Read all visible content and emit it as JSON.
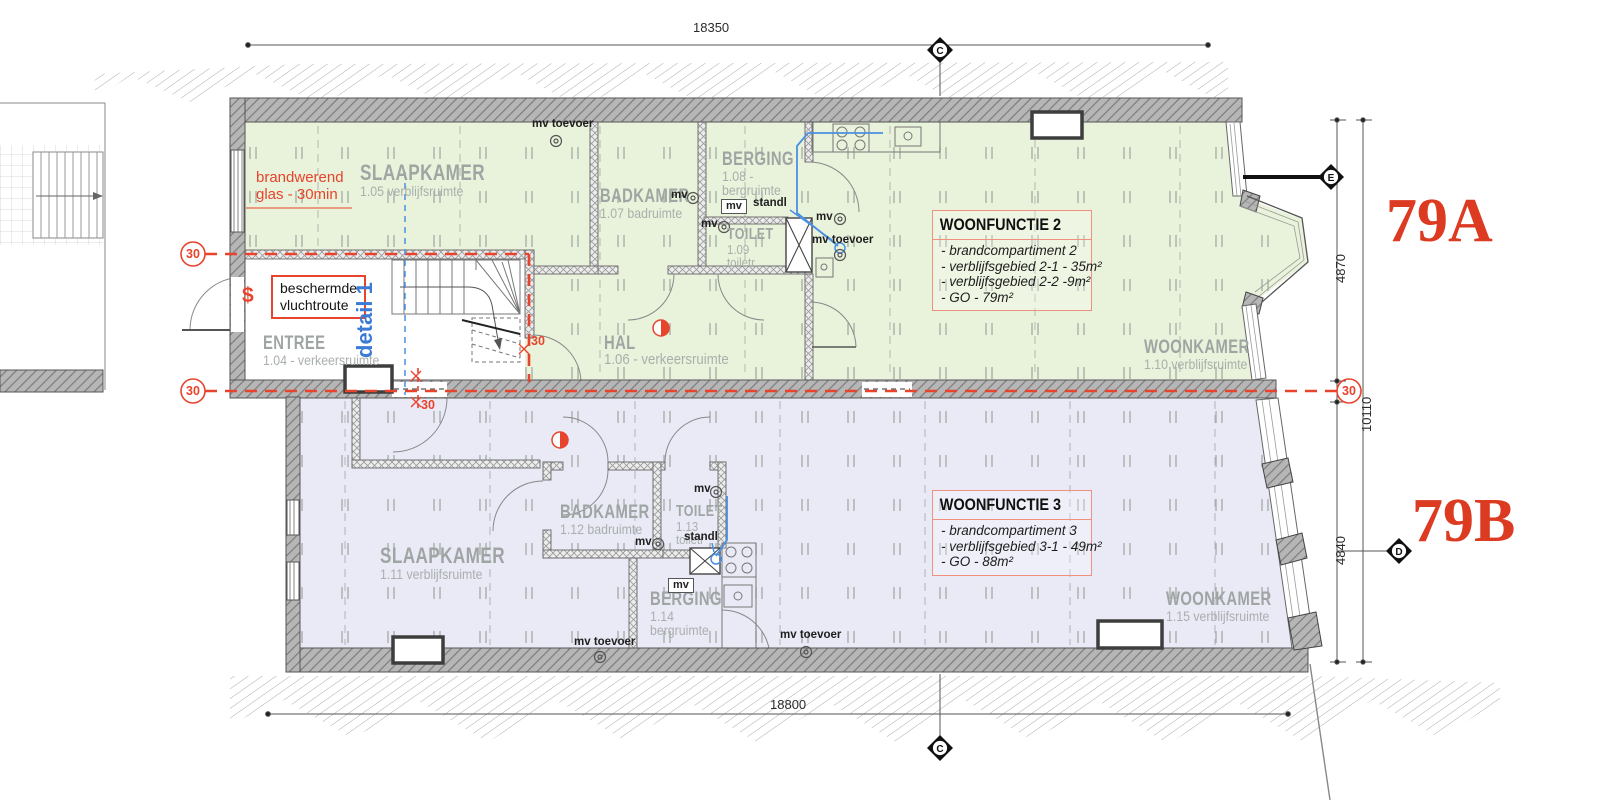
{
  "plan": {
    "dimensions": {
      "top": "18350",
      "bottom": "18800",
      "right_upper": "4870",
      "right_middle": "10110",
      "right_lower": "4840"
    },
    "grid_markers": {
      "top": "C",
      "bottom": "C",
      "right_upper": "E",
      "right_lower": "D"
    },
    "fire_ratings": {
      "left_upper": "30",
      "left_lower": "30",
      "right": "30",
      "stair_side": "30",
      "stair_bottom": "30"
    },
    "annotations": {
      "fire_glass_line1": "brandwerend",
      "fire_glass_line2": "glas - 30min",
      "escape_route_line1": "beschermde",
      "escape_route_line2": "vluchtroute",
      "detail_ref": "detail 1",
      "section_symbol": "$"
    },
    "unit_a": {
      "house_number": "79A",
      "info_box": {
        "title": "WOONFUNCTIE 2",
        "lines": [
          "- brandcompartiment 2",
          "- verblijfsgebied 2-1 - 35m²",
          "- verblijfsgebied 2-2 -9m²",
          "- GO - 79m²"
        ]
      },
      "rooms": {
        "slaapkamer": {
          "name": "SLAAPKAMER",
          "info": "1.05 verblijfsruimte"
        },
        "badkamer": {
          "name": "BADKAMER",
          "info": "1.07 badruimte"
        },
        "berging": {
          "name": "BERGING",
          "info": "1.08 -",
          "info2": "bergruimte"
        },
        "toilet": {
          "name": "TOILET",
          "info": "1.09",
          "info2": "toiletr."
        },
        "hal": {
          "name": "HAL",
          "info": "1.06 - verkeersruimte"
        },
        "entree": {
          "name": "ENTREE",
          "info": "1.04 - verkeersruimte"
        },
        "woonkamer": {
          "name": "WOONKAMER",
          "info": "1.10 verblijfsruimte"
        }
      }
    },
    "unit_b": {
      "house_number": "79B",
      "info_box": {
        "title": "WOONFUNCTIE 3",
        "lines": [
          "- brandcompartiment 3",
          "- verblijfsgebied 3-1 - 49m²",
          "- GO - 88m²"
        ]
      },
      "rooms": {
        "slaapkamer": {
          "name": "SLAAPKAMER",
          "info": "1.11 verblijfsruimte"
        },
        "badkamer": {
          "name": "BADKAMER",
          "info": "1.12 badruimte"
        },
        "toilet": {
          "name": "TOILET",
          "info": "1.13",
          "info2": "toiletr"
        },
        "berging": {
          "name": "BERGING",
          "info": "1.14",
          "info2": "bergruimte"
        },
        "woonkamer": {
          "name": "WOONKAMER",
          "info": "1.15 verblijfsruimte"
        }
      }
    },
    "service_labels": {
      "mv": "mv",
      "mv_toevoer": "mv toevoer",
      "standleiding": "standl"
    },
    "colors": {
      "unit_a_fill": "#e9f2da",
      "unit_b_fill": "#eaeaf7",
      "wall": "#b6b6b6",
      "fire_red": "#e8432c",
      "pipe_blue": "#4a90e2",
      "label_gray": "#9fa5a3",
      "accent_salmon": "#f0907e",
      "house_number_red": "#dd3a22"
    }
  }
}
